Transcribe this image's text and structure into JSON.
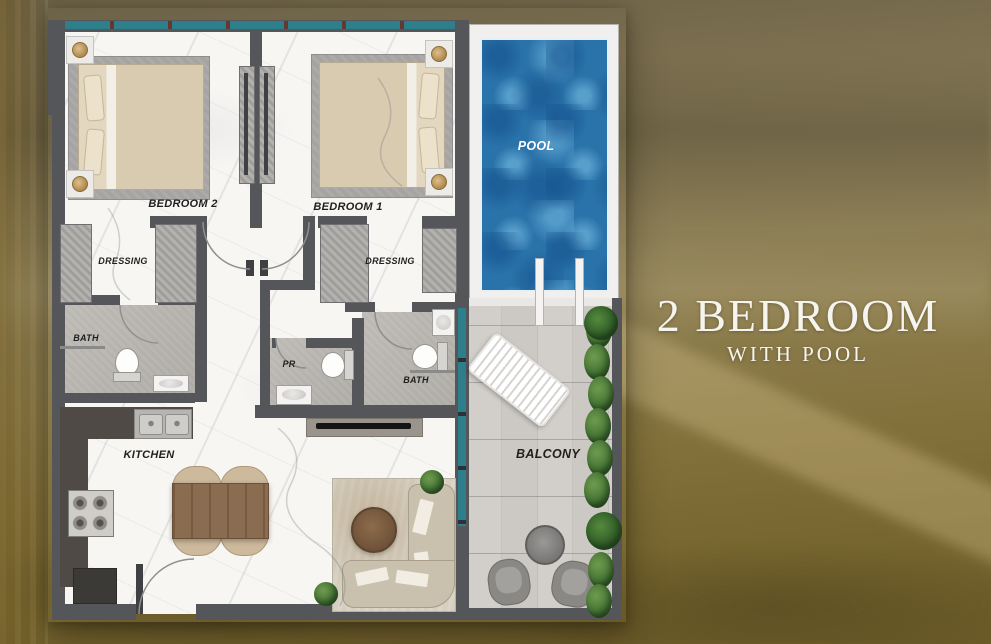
{
  "title": {
    "line1": "2 BEDROOM",
    "line2": "WITH POOL"
  },
  "plan": {
    "labels": {
      "bedroom2": "BEDROOM 2",
      "bedroom1": "BEDROOM 1",
      "dressing_left": "DRESSING",
      "dressing_right": "DRESSING",
      "bath_left": "BATH",
      "bath_right": "BATH",
      "powder_room": "PR",
      "kitchen": "KITCHEN",
      "pool": "POOL",
      "balcony": "BALCONY"
    }
  },
  "colors": {
    "background_gold": "#87774d",
    "title_text": "#f6f4ef",
    "wall_gray": "#55565a",
    "glazing_teal": "#2e7f8c",
    "pool_water_blue": "#2a73aa",
    "marble_floor": "#f7f6f3",
    "balcony_wood": "#cecbc6",
    "plants_green": "#477636"
  }
}
